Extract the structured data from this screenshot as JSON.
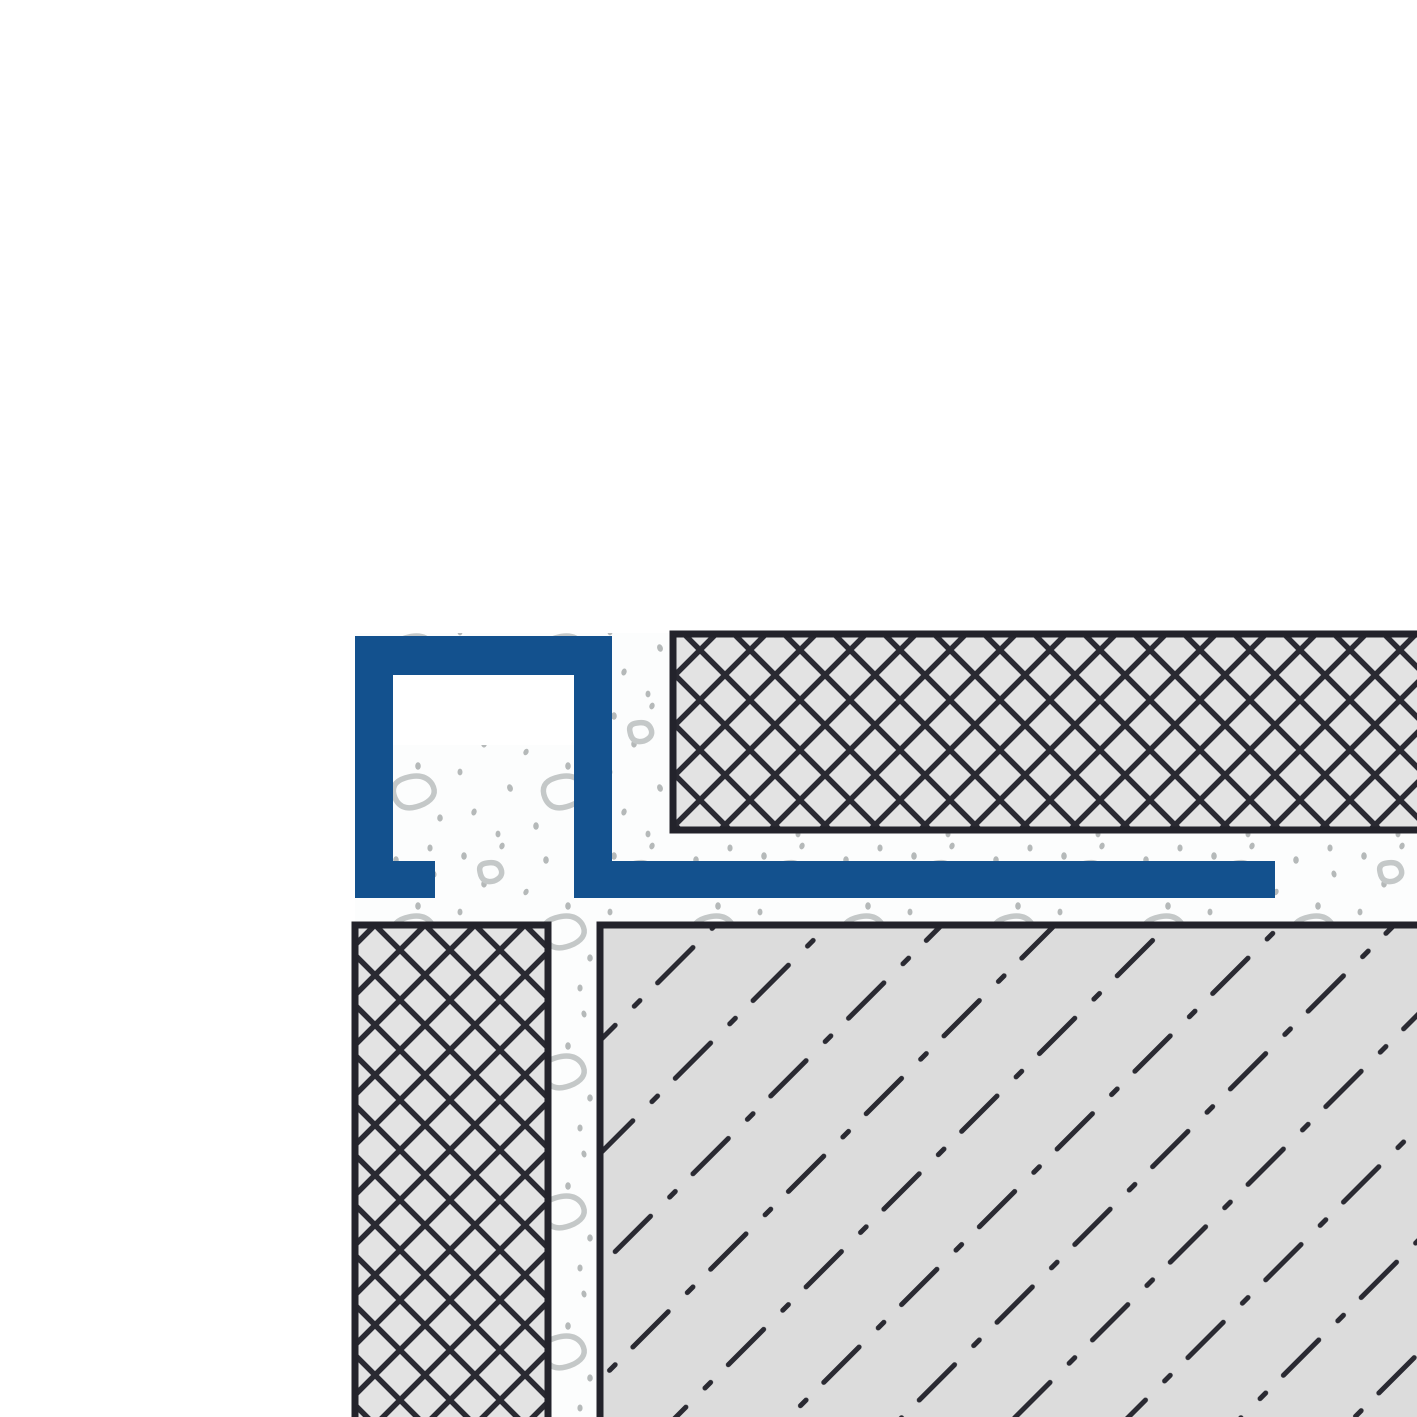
{
  "diagram": {
    "title": "Square tile edge profile installation cross-section",
    "parts": {
      "profile": "square-edge-profile",
      "top_tile": "tile-crosshatch",
      "left_tile": "tile-crosshatch",
      "mortar": "thin-bed-mortar",
      "substrate": "screed-substrate"
    }
  },
  "colors": {
    "background": "#ffffff",
    "profile_blue": "#13518e",
    "tile_fill": "#e3e3e3",
    "substrate_fill": "#dcdcdc",
    "outline_dark": "#23232b",
    "hatch_dark": "#2a2a32",
    "mortar_bg": "#fcfdfd",
    "mortar_dot": "#b5b9b9",
    "pebble_gray": "#c4c8c8"
  }
}
